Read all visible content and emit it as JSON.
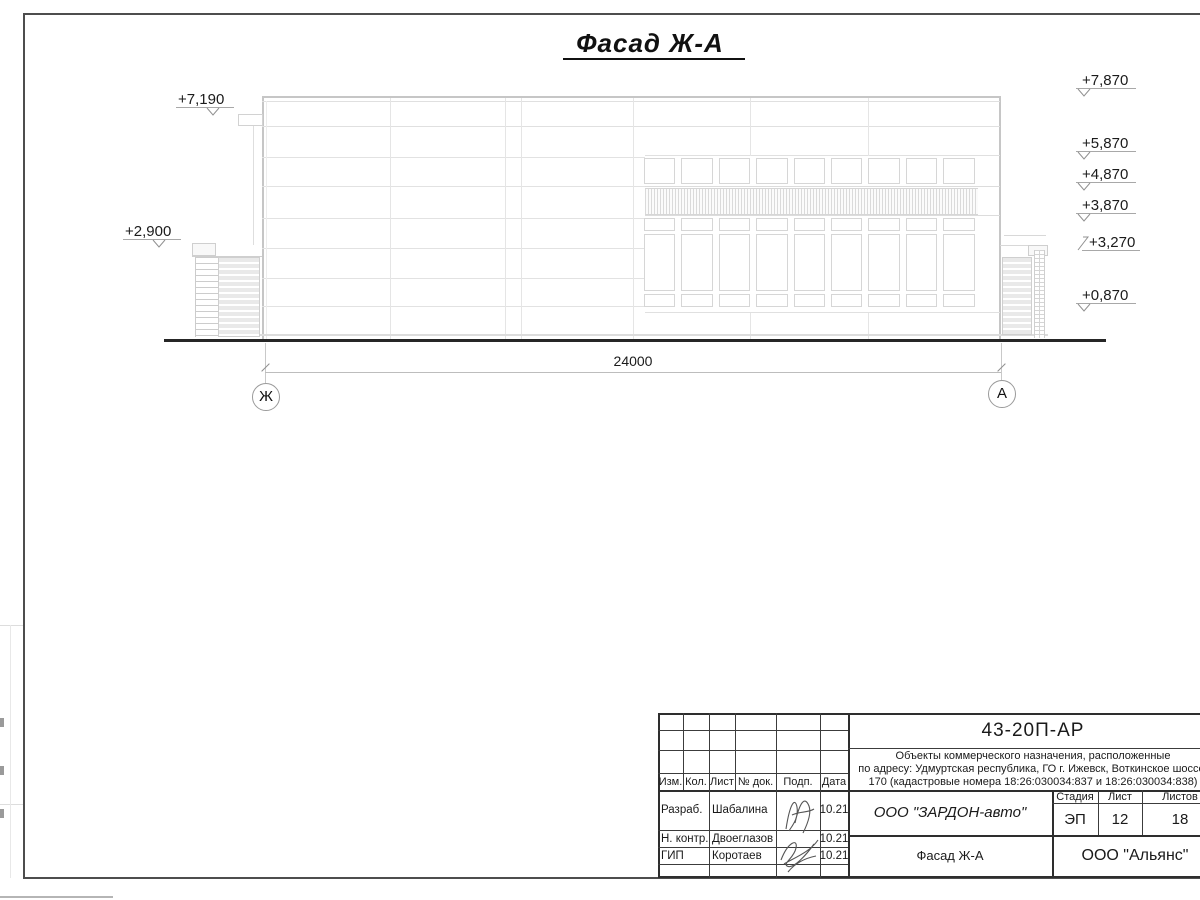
{
  "sheet": {
    "title": "Фасад Ж-А "
  },
  "drawing": {
    "dimension_total": "24000",
    "axis_left": "Ж",
    "axis_right": "А",
    "elevations_left": [
      {
        "label": "+7,190"
      },
      {
        "label": "+2,900"
      }
    ],
    "elevations_right": [
      {
        "label": "+7,870"
      },
      {
        "label": "+5,870"
      },
      {
        "label": "+4,870"
      },
      {
        "label": "+3,870"
      },
      {
        "label": "+3,270"
      },
      {
        "label": "+0,870"
      }
    ]
  },
  "title_block": {
    "doc_number": "43-20П-АР",
    "project_line1": "Объекты коммерческого назначения, расположенные",
    "project_line2": "по адресу: Удмуртская республика, ГО г. Ижевск, Воткинское шоссе,",
    "project_line3": "170 (кадастровые номера 18:26:030034:837 и 18:26:030034:838)",
    "rev_headers": {
      "izm": "Изм.",
      "kol": "Кол.",
      "list": "Лист",
      "doc": "№ док.",
      "podp": "Подп.",
      "data": "Дата"
    },
    "stage": {
      "header_stage": "Стадия",
      "header_sheet": "Лист",
      "header_sheets": "Листов",
      "stage": "ЭП",
      "sheet": "12",
      "sheets": "18"
    },
    "rows": [
      {
        "role": "Разраб.",
        "name": "Шабалина",
        "date": "10.21"
      },
      {
        "role": "Н. контр.",
        "name": "Двоеглазов",
        "date": "10.21"
      },
      {
        "role": "ГИП",
        "name": "Коротаев",
        "date": "10.21"
      }
    ],
    "customer": "ООО \"ЗАРДОН-авто\"",
    "sheet_name": "Фасад Ж-А",
    "designer": "ООО \"Альянс\""
  }
}
